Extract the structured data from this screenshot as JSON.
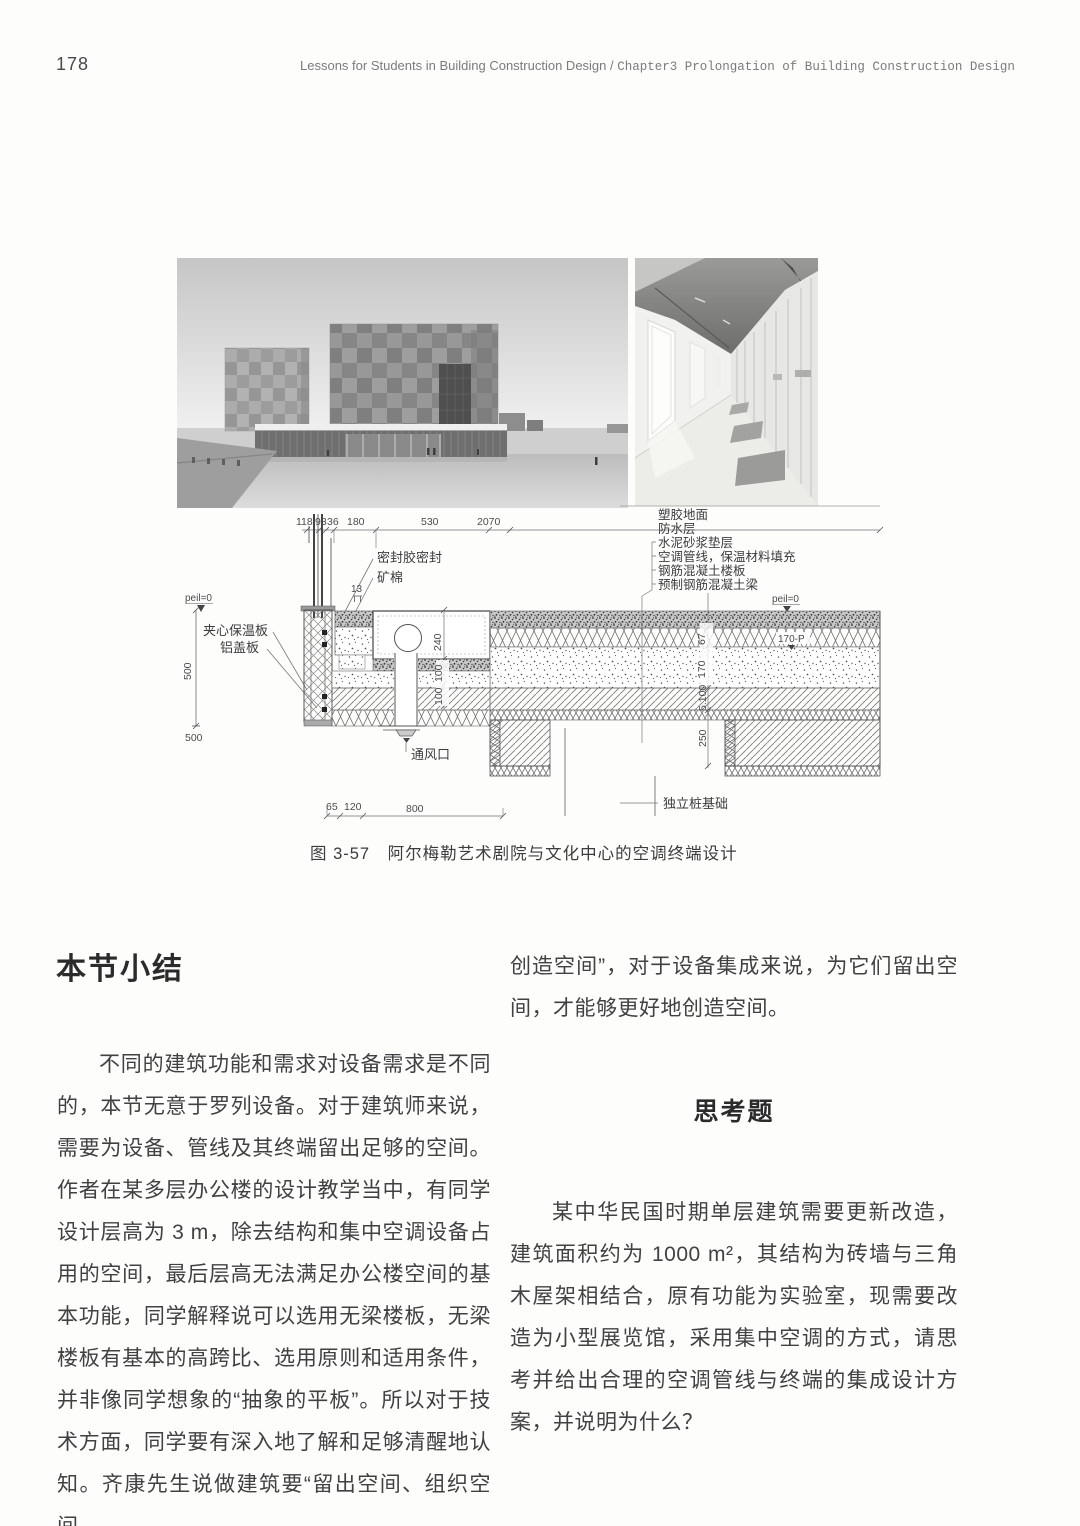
{
  "header": {
    "page_number": "178",
    "title_book": "Lessons for Students in Building Construction Design",
    "title_sep": "/",
    "title_chapter": "Chapter3  Prolongation of Building Construction Design"
  },
  "figure": {
    "caption": "图 3-57　阿尔梅勒艺术剧院与文化中心的空调终端设计",
    "drawing": {
      "dims_top": [
        "118",
        "93",
        "36",
        "180",
        "530",
        "2070"
      ],
      "dims_bottom": [
        "65",
        "120",
        "800"
      ],
      "dims_left": {
        "v500": "500",
        "b500": "500"
      },
      "dims_mid": {
        "d240": "240",
        "d100a": "100",
        "d100b": "100"
      },
      "dims_right": {
        "d67": "67",
        "d170": "170",
        "d5100": "5.100",
        "d250": "250"
      },
      "labels": {
        "sealant": "密封胶密封",
        "mineral_wool": "矿棉",
        "dim13": "13",
        "peil_left": "peil=0",
        "peil_right": "peil=0",
        "level_170": "170-P",
        "sandwich_panel": "夹心保温板",
        "aluminum_cover": "铝盖板",
        "vent": "通风口",
        "pile_foundation": "独立桩基础"
      },
      "layer_labels": [
        "塑胶地面",
        "防水层",
        "水泥砂浆垫层",
        "空调管线，保温材料填充",
        "钢筋混凝土楼板",
        "预制钢筋混凝土梁"
      ]
    }
  },
  "sections": {
    "summary": {
      "heading": "本节小结",
      "paragraph": "不同的建筑功能和需求对设备需求是不同的，本节无意于罗列设备。对于建筑师来说，需要为设备、管线及其终端留出足够的空间。作者在某多层办公楼的设计教学当中，有同学设计层高为 3 m，除去结构和集中空调设备占用的空间，最后层高无法满足办公楼空间的基本功能，同学解释说可以选用无梁楼板，无梁楼板有基本的高跨比、选用原则和适用条件，并非像同学想象的“抽象的平板”。所以对于技术方面，同学要有深入地了解和足够清醒地认知。齐康先生说做建筑要“留出空间、组织空间、",
      "continuation": "创造空间”，对于设备集成来说，为它们留出空间，才能够更好地创造空间。"
    },
    "questions": {
      "heading": "思考题",
      "paragraph": "某中华民国时期单层建筑需要更新改造，建筑面积约为 1000 m²，其结构为砖墙与三角木屋架相结合，原有功能为实验室，现需要改造为小型展览馆，采用集中空调的方式，请思考并给出合理的空调管线与终端的集成设计方案，并说明为什么？"
    }
  }
}
